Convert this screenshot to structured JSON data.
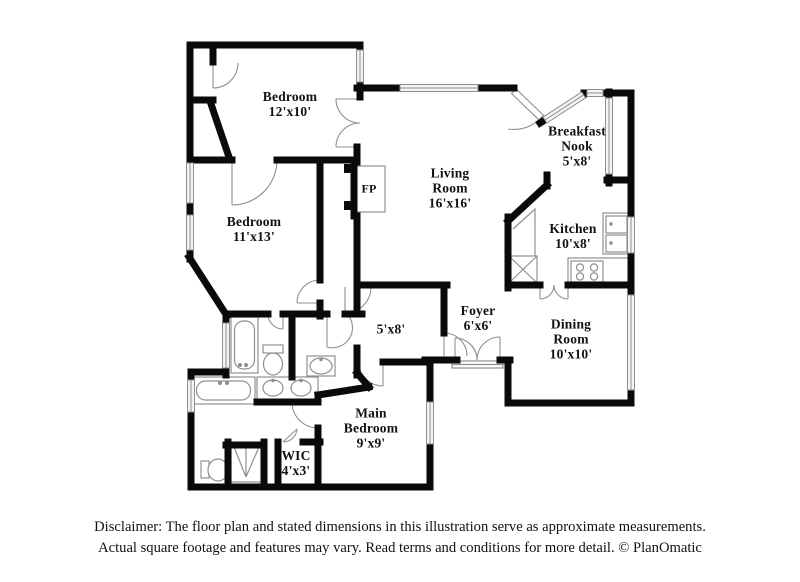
{
  "rooms": {
    "bedroom_top": {
      "line1": "Bedroom",
      "line2": "12'x10'"
    },
    "bedroom_left": {
      "line1": "Bedroom",
      "line2": "11'x13'"
    },
    "living": {
      "line1": "Living",
      "line2": "Room",
      "line3": "16'x16'"
    },
    "breakfast": {
      "line1": "Breakfast",
      "line2": "Nook",
      "line3": "5'x8'"
    },
    "kitchen": {
      "line1": "Kitchen",
      "line2": "10'x8'"
    },
    "foyer": {
      "line1": "Foyer",
      "line2": "6'x6'"
    },
    "dining": {
      "line1": "Dining",
      "line2": "Room",
      "line3": "10'x10'"
    },
    "hall": {
      "line1": "5'x8'"
    },
    "main_bedroom": {
      "line1": "Main",
      "line2": "Bedroom",
      "line3": "9'x9'"
    },
    "wic": {
      "line1": "WIC",
      "line2": "4'x3'"
    },
    "fireplace": {
      "line1": "FP"
    }
  },
  "footer": {
    "line1": "Disclaimer: The floor plan and stated dimensions in this illustration serve as approximate measurements.",
    "line2": "Actual square footage and features may vary. Read terms and conditions for more detail. © PlanOmatic"
  },
  "colors": {
    "wall": "#0a0a0a",
    "fixture_line": "#8f8f8f",
    "window_fill": "#f4f4f4",
    "text": "#111111",
    "background": "#ffffff"
  }
}
